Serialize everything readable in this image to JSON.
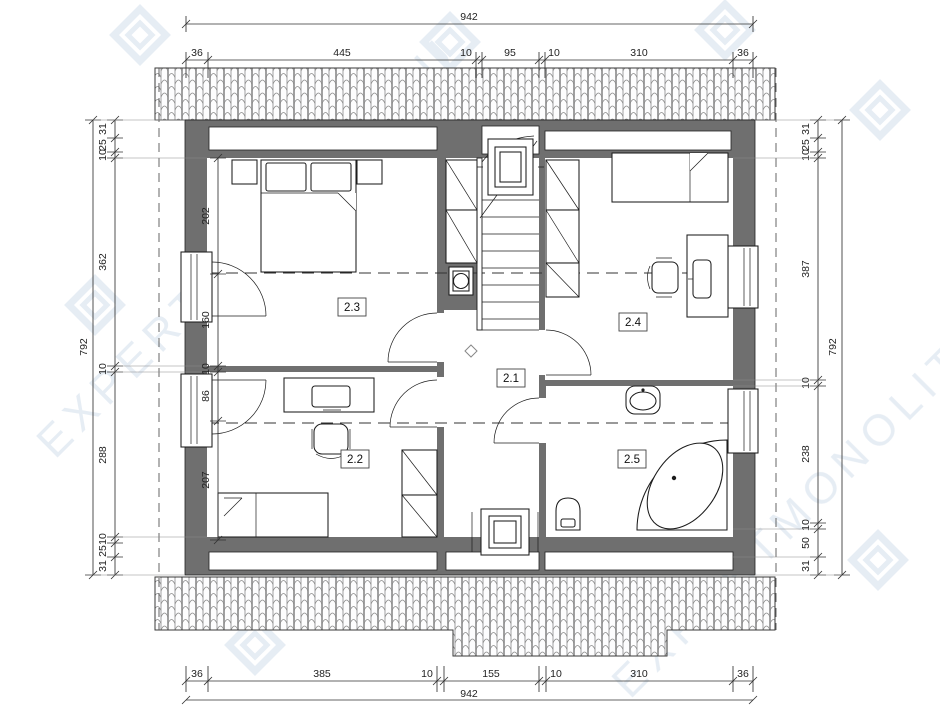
{
  "watermark": {
    "text": "EXPERTMONOLIT.RU"
  },
  "rooms": [
    {
      "id": "hall",
      "label": "2.1"
    },
    {
      "id": "bedroom-sw",
      "label": "2.2"
    },
    {
      "id": "bedroom-nw",
      "label": "2.3"
    },
    {
      "id": "bedroom-east",
      "label": "2.4"
    },
    {
      "id": "bathroom",
      "label": "2.5"
    }
  ],
  "dims": {
    "top": {
      "total": "942",
      "segments": [
        "36",
        "445",
        "10",
        "95",
        "10",
        "310",
        "36"
      ]
    },
    "bottom": {
      "total": "942",
      "segments": [
        "36",
        "385",
        "10",
        "155",
        "10",
        "310",
        "36"
      ]
    },
    "left_outer": {
      "total": "792",
      "segments": [
        "31",
        "25",
        "10",
        "362",
        "10",
        "288",
        "10",
        "25",
        "31"
      ]
    },
    "left_inner": {
      "segments": [
        "202",
        "160",
        "10",
        "86",
        "207"
      ]
    },
    "right": {
      "total": "792",
      "segments": [
        "31",
        "25",
        "10",
        "387",
        "10",
        "238",
        "10",
        "50",
        "31"
      ]
    }
  },
  "colors": {
    "wall": "#6f6f6f",
    "line": "#1c1c1c",
    "dimension": "#333333",
    "watermark": "#e4ebf3",
    "background": "#ffffff"
  }
}
